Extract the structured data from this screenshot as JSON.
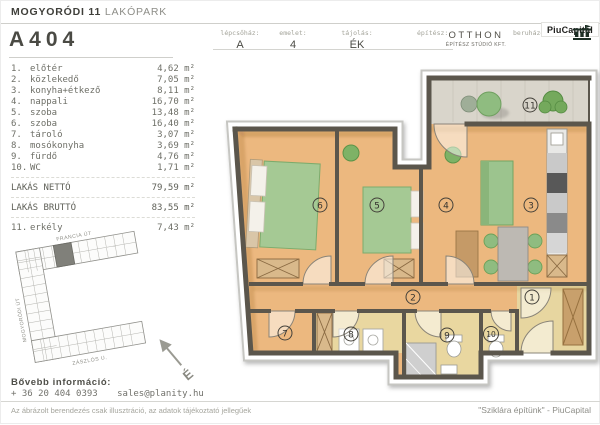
{
  "header": {
    "project_name_bold": "MOGYORÓDI 11",
    "project_name_light": "LAKÓPARK",
    "unit_id": "A404"
  },
  "info_table": {
    "staircase_label": "lépcsőház:",
    "staircase_value": "A",
    "floor_label": "emelet:",
    "floor_value": "4",
    "orientation_label": "tájolás:",
    "orientation_value": "ÉK",
    "architect_label": "építész:",
    "architect_name": "OTTHON",
    "architect_sub": "ÉPÍTÉSZ STÚDIÓ KFT.",
    "developer_label": "beruházó:",
    "developer_name": "PiuCapital"
  },
  "room_list": {
    "rooms": [
      {
        "num": "1.",
        "name": "előtér",
        "area": "4,62 m²"
      },
      {
        "num": "2.",
        "name": "közlekedő",
        "area": "7,05 m²"
      },
      {
        "num": "3.",
        "name": "konyha+étkező",
        "area": "8,11 m²"
      },
      {
        "num": "4.",
        "name": "nappali",
        "area": "16,70 m²"
      },
      {
        "num": "5.",
        "name": "szoba",
        "area": "13,48 m²"
      },
      {
        "num": "6.",
        "name": "szoba",
        "area": "16,40 m²"
      },
      {
        "num": "7.",
        "name": "tároló",
        "area": "3,07 m²"
      },
      {
        "num": "8.",
        "name": "mosókonyha",
        "area": "3,69 m²"
      },
      {
        "num": "9.",
        "name": "fürdő",
        "area": "4,76 m²"
      },
      {
        "num": "10.",
        "name": "WC",
        "area": "1,71 m²"
      }
    ],
    "net_label": "LAKÁS NETTÓ",
    "net_area": "79,59 m²",
    "gross_label": "LAKÁS BRUTTÓ",
    "gross_area": "83,55 m²",
    "balcony_num": "11.",
    "balcony_name": "erkély",
    "balcony_area": "7,43 m²"
  },
  "site_plan": {
    "street_top": "FRANCIA ÚT",
    "street_left": "MOGYORÓDI ÚT",
    "street_bottom": "ZÁSZLÓS U."
  },
  "floor_plan": {
    "room_numbers": [
      "1",
      "2",
      "3",
      "4",
      "5",
      "6",
      "7",
      "8",
      "9",
      "10",
      "11"
    ],
    "north_label": "É"
  },
  "contact": {
    "heading": "Bővebb információ:",
    "phone": "+ 36 20 404 0393",
    "email": "sales@planity.hu"
  },
  "footer": {
    "disclaimer": "Az ábrázolt berendezés csak illusztráció, az adatok tájékoztató jellegűek",
    "slogan": "\"Sziklára építünk\" - PiuCapital"
  },
  "colors": {
    "floor_wood": "#ecb87f",
    "floor_wet": "#e9d7a0",
    "balcony_floor": "#d9d5cb",
    "wall": "#5b564c",
    "furniture_green": "#9cc48e",
    "logo_dark": "#1c2e24"
  }
}
